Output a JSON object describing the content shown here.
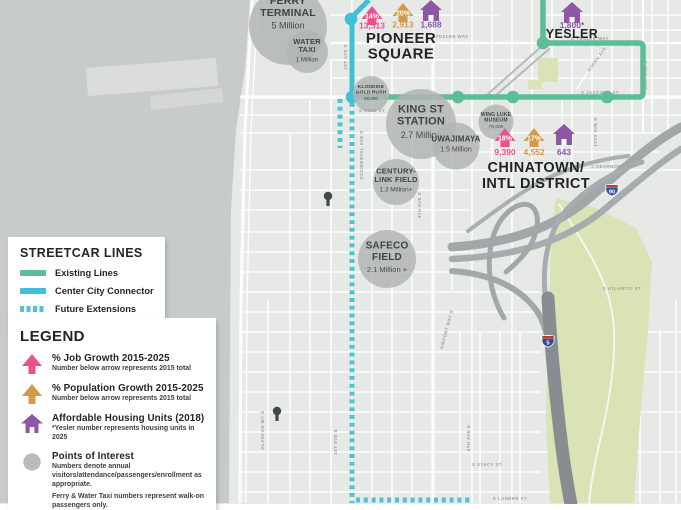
{
  "colors": {
    "existing_line": "#5cbe96",
    "connector_line": "#3fc1d3",
    "future_line": "#4cc4d4",
    "job_growth": "#e8538d",
    "population_growth": "#d49a4c",
    "affordable_housing": "#8d57a6",
    "poi_circle": "#b2b5b3",
    "water": "#c7ccca",
    "land": "#e7e9e7",
    "park": "#d9e3b6",
    "highway": "#a2a8a9",
    "freeway_dark": "#878d90",
    "text_dark": "#232527",
    "street_label": "#99a09e"
  },
  "streetcar_legend": {
    "title": "STREETCAR LINES",
    "items": [
      {
        "label": "Existing Lines",
        "swatch": "solid-green"
      },
      {
        "label": "Center City Connector",
        "swatch": "solid-cyan"
      },
      {
        "label": "Future Extensions",
        "swatch": "dashed-cyan"
      }
    ]
  },
  "legend": {
    "title": "LEGEND",
    "items": [
      {
        "icon": "job-growth-arrow",
        "label": "% Job Growth 2015-2025",
        "subs": [
          "Number below arrow represents 2015 total"
        ]
      },
      {
        "icon": "population-growth-arrow",
        "label": "% Population Growth 2015-2025",
        "subs": [
          "Number below arrow represents 2015 total"
        ]
      },
      {
        "icon": "affordable-housing-house",
        "label": "Affordable Housing Units (2018)",
        "subs": [
          "*Yesler number represents housing units in 2025"
        ]
      },
      {
        "icon": "poi-circle",
        "label": "Points of Interest",
        "subs": [
          "Numbers denote annual visitors/attendance/passengers/enrollment as appropriate.",
          "Ferry & Water Taxi numbers represent walk-on passengers only."
        ]
      }
    ]
  },
  "districts": [
    {
      "name": "PIONEER SQUARE",
      "lines": [
        "PIONEER",
        "SQUARE"
      ],
      "x": 401,
      "y": 43,
      "lh": 15.5,
      "fs": 15
    },
    {
      "name": "CHINATOWN/INTL DISTRICT",
      "lines": [
        "CHINATOWN/",
        "INTL DISTRICT"
      ],
      "x": 536,
      "y": 172,
      "lh": 16,
      "fs": 14.5
    },
    {
      "name": "YESLER",
      "lines": [
        "YESLER"
      ],
      "x": 572,
      "y": 38,
      "lh": 13,
      "fs": 12.5
    }
  ],
  "growth_markers": [
    {
      "district": "PIONEER SQUARE",
      "kind": "job-growth",
      "pct": "14%",
      "total": "13,513",
      "x": 372,
      "y": 6,
      "ny": 28.5
    },
    {
      "district": "PIONEER SQUARE",
      "kind": "population-growth",
      "pct": "20%",
      "total": "2,913",
      "x": 403,
      "y": 3,
      "ny": 27.5
    },
    {
      "district": "PIONEER SQUARE",
      "kind": "affordable-housing",
      "total": "1,688",
      "x": 431,
      "y": 0,
      "ny": 27.5
    },
    {
      "district": "CHINATOWN/INTL DISTRICT",
      "kind": "job-growth",
      "pct": "18%",
      "total": "9,390",
      "x": 505,
      "y": 128,
      "ny": 155
    },
    {
      "district": "CHINATOWN/INTL DISTRICT",
      "kind": "population-growth",
      "pct": "17%",
      "total": "4,552",
      "x": 534,
      "y": 128,
      "ny": 155
    },
    {
      "district": "CHINATOWN/INTL DISTRICT",
      "kind": "affordable-housing",
      "total": "643",
      "x": 564,
      "y": 124,
      "ny": 155
    },
    {
      "district": "YESLER",
      "kind": "affordable-housing",
      "total": "1,800*",
      "x": 572,
      "y": 2,
      "ny": 28
    }
  ],
  "pois": [
    {
      "name": "FERRY TERMINAL",
      "lines": [
        "FERRY",
        "TERMINAL"
      ],
      "value": "5 Million",
      "cx": 288,
      "cy": 26,
      "r": 39,
      "nfs": 10.5,
      "vfs": 9,
      "ty": 4
    },
    {
      "name": "WATER TAXI",
      "lines": [
        "WATER",
        "TAXI"
      ],
      "value": "1 Million",
      "cx": 307,
      "cy": 52,
      "r": 21,
      "nfs": 7.5,
      "vfs": 6
    },
    {
      "name": "KLONDIKE GOLD RUSH",
      "lines": [
        "KLONDIKE",
        "GOLD RUSH"
      ],
      "value": "85,000",
      "cx": 371,
      "cy": 94,
      "r": 18,
      "nfs": 4.8,
      "vfs": 4.5
    },
    {
      "name": "KING ST STATION",
      "lines": [
        "KING ST",
        "STATION"
      ],
      "value": "2.7 Million",
      "cx": 421,
      "cy": 124,
      "r": 35,
      "nfs": 11,
      "vfs": 9
    },
    {
      "name": "UWAJIMAYA",
      "lines": [
        "UWAJIMAYA"
      ],
      "value": "1.5 Million",
      "cx": 456,
      "cy": 146,
      "r": 23.5,
      "nfs": 8,
      "vfs": 7
    },
    {
      "name": "WING LUKE MUSEUM",
      "lines": [
        "WING LUKE",
        "MUSEUM"
      ],
      "value": "70,000",
      "cx": 496,
      "cy": 122,
      "r": 17.5,
      "nfs": 5,
      "vfs": 4.8
    },
    {
      "name": "CENTURY-LINK FIELD",
      "lines": [
        "CENTURY-",
        "LINK FIELD"
      ],
      "value": "1.3 Million+",
      "cx": 396,
      "cy": 182,
      "r": 23,
      "nfs": 7.5,
      "vfs": 6.5
    },
    {
      "name": "SAFECO FIELD",
      "lines": [
        "SAFECO",
        "FIELD"
      ],
      "value": "2.1 Million +",
      "cx": 387,
      "cy": 259,
      "r": 29,
      "nfs": 10,
      "vfs": 7.5
    }
  ],
  "stations": [
    {
      "line": "center-city-connector",
      "x": 351,
      "y": 19
    },
    {
      "line": "center-city-connector",
      "x": 352,
      "y": 97
    },
    {
      "line": "existing",
      "x": 458,
      "y": 97
    },
    {
      "line": "existing",
      "x": 513,
      "y": 97
    },
    {
      "line": "existing",
      "x": 607,
      "y": 97
    },
    {
      "line": "existing",
      "x": 543,
      "y": 43
    }
  ],
  "street_labels": [
    {
      "name": "YESLER WAY",
      "x": 452,
      "y": 38,
      "rot": 0
    },
    {
      "name": "E YESLER WAY",
      "x": 590,
      "y": 40,
      "rot": 0
    },
    {
      "name": "S JACKSON ST",
      "x": 600,
      "y": 94,
      "rot": 0
    },
    {
      "name": "S KING ST",
      "x": 372,
      "y": 112,
      "rot": 0
    },
    {
      "name": "S DEARBORN ST",
      "x": 612,
      "y": 168,
      "rot": 0
    },
    {
      "name": "S ATLANTIC ST",
      "x": 622,
      "y": 290,
      "rot": 0
    },
    {
      "name": "S STACY ST",
      "x": 487,
      "y": 466,
      "rot": 0
    },
    {
      "name": "S LANDER ST",
      "x": 510,
      "y": 500,
      "rot": 0
    },
    {
      "name": "1ST AVE S",
      "x": 347,
      "y": 57,
      "rot": -90
    },
    {
      "name": "1ST AVE S",
      "x": 337,
      "y": 442,
      "rot": -90
    },
    {
      "name": "OCCIDENTAL AVE S",
      "x": 363,
      "y": 155,
      "rot": -90
    },
    {
      "name": "4TH AVE S",
      "x": 421,
      "y": 205,
      "rot": -90
    },
    {
      "name": "ALASKAN WY S",
      "x": 264,
      "y": 430,
      "rot": -90
    },
    {
      "name": "14TH AVE S",
      "x": 647,
      "y": 75,
      "rot": -90
    },
    {
      "name": "12TH AVE S",
      "x": 597,
      "y": 132,
      "rot": -90
    },
    {
      "name": "BOREN AVE",
      "x": 598,
      "y": 60,
      "rot": -55
    },
    {
      "name": "6TH AVE S",
      "x": 470,
      "y": 438,
      "rot": -90
    },
    {
      "name": "AIRPORT WAY S",
      "x": 448,
      "y": 330,
      "rot": -75
    }
  ],
  "shields": [
    {
      "route": "90",
      "x": 612,
      "y": 184
    },
    {
      "route": "5",
      "x": 548,
      "y": 335
    }
  ]
}
